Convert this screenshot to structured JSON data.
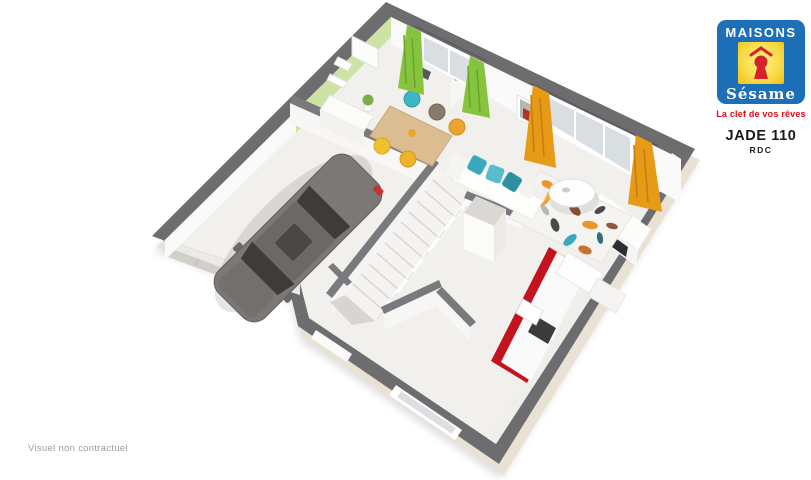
{
  "logo": {
    "brand_top": "MAISONS",
    "brand_bottom": "Sésame",
    "tagline": "La clef de vos rêves",
    "colors": {
      "box_blue": "#1d70b7",
      "square_yellow": "#f9dc4a",
      "keyhole_red": "#d5222b",
      "tagline_red": "#e30617"
    }
  },
  "plan_label": {
    "model": "JADE 110",
    "level": "RDC"
  },
  "footer": {
    "disclaimer": "Visuel non contractuel"
  },
  "palette": {
    "exterior_wall_gray": "#6d6d70",
    "interior_wall_gray": "#7a7a7e",
    "floor_white": "#f2f0ed",
    "outer_face_cream": "#e9e2d4",
    "accent_wall_green": "#cde2a5",
    "curtain_green": "#86c440",
    "curtain_orange": "#e79a16",
    "kitchen_red": "#c3131f",
    "car_gray": "#7b7875",
    "table_wood": "#dcbd92",
    "chair_teal": "#3fb4c4",
    "chair_orange": "#eda32f",
    "chair_yellow": "#f0c02e"
  }
}
